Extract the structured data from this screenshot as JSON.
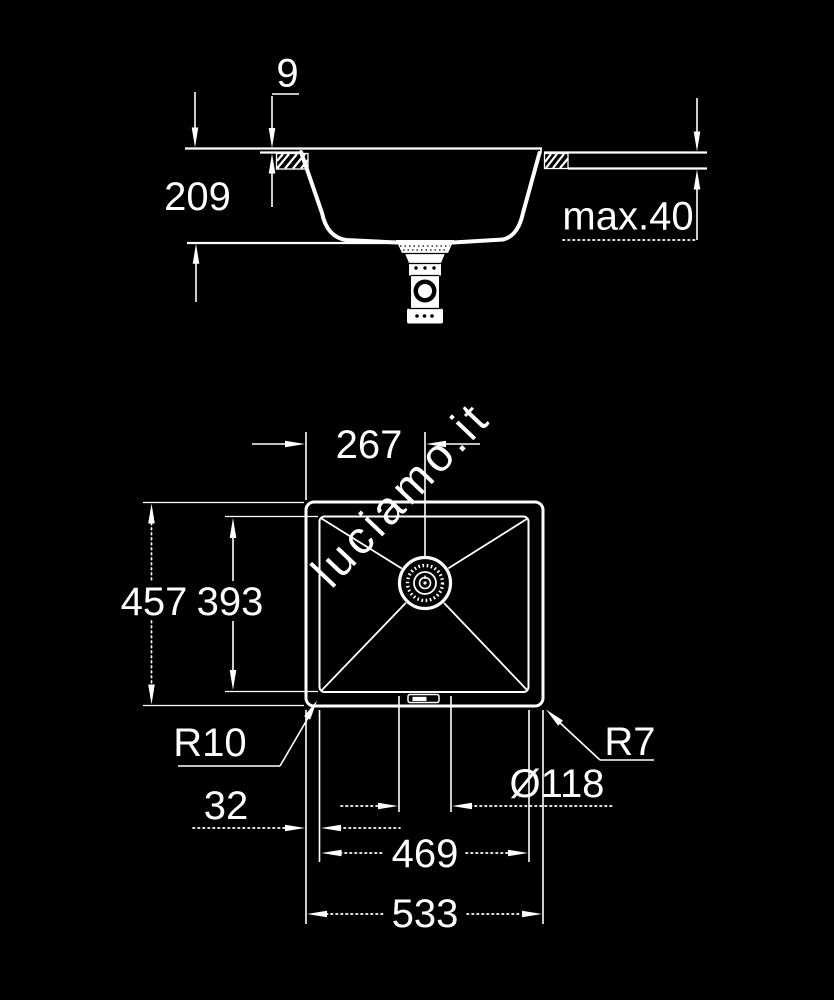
{
  "watermark": "luciamo.it",
  "colors": {
    "background": "#000000",
    "line": "#ffffff",
    "watermark": "#2c2c2c"
  },
  "side_view": {
    "rim_thickness": "9",
    "bowl_depth": "209",
    "countertop_max_thickness": "max.40"
  },
  "plan_view": {
    "drain_center_from_left": "267",
    "outer_length": "457",
    "bowl_length": "393",
    "bowl_corner_radius": "R10",
    "outer_corner_radius": "R7",
    "drain_diameter": "Ø118",
    "edge_to_bowl": "32",
    "bowl_width": "469",
    "outer_width": "533"
  }
}
